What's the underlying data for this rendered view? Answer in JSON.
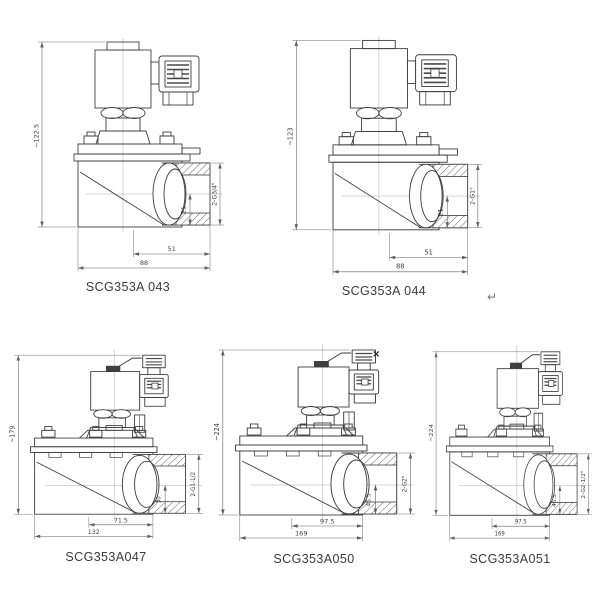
{
  "sheet": {
    "background": "#ffffff",
    "line_color": "#3f3f3f",
    "dim_color": "#5f5f5f",
    "text_color": "#3e3e3e"
  },
  "marks": {
    "return_mark": "↵",
    "cross_mark": "×"
  },
  "valves": [
    {
      "model": "SCG353A 043",
      "style": "small",
      "dims": {
        "height": "~122.5",
        "inner_width": "51",
        "outer_width": "88",
        "port_depth": "21",
        "thread": "2-G3/4\""
      }
    },
    {
      "model": "SCG353A 044",
      "style": "small",
      "dims": {
        "height": "~123",
        "inner_width": "51",
        "outer_width": "88",
        "port_depth": "21",
        "thread": "2-G1\""
      }
    },
    {
      "model": "SCG353A047",
      "style": "large",
      "dims": {
        "height": "~179",
        "inner_width": "71.5",
        "outer_width": "132",
        "port_depth": "30",
        "thread": "2-G1-1/2"
      }
    },
    {
      "model": "SCG353A050",
      "style": "large",
      "dims": {
        "height": "~224",
        "inner_width": "97.5",
        "outer_width": "169",
        "port_depth": "45.5",
        "thread": "2-G2\""
      }
    },
    {
      "model": "SCG353A051",
      "style": "large",
      "dims": {
        "height": "~224",
        "inner_width": "97.5",
        "outer_width": "169",
        "port_depth": "45.5",
        "thread": "2-G2-1/2\""
      }
    }
  ]
}
